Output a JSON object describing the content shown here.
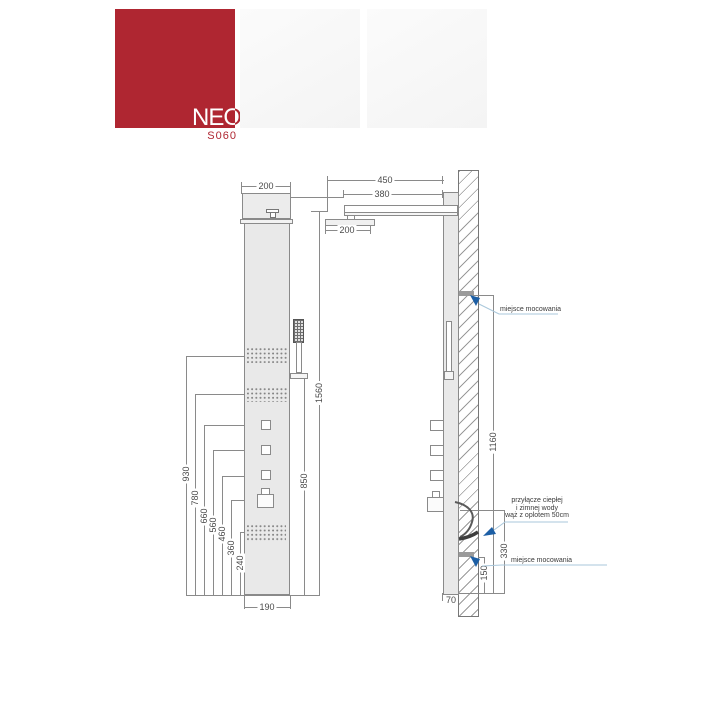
{
  "logo": {
    "brand": "NEO",
    "model": "S060",
    "brand_color": "#AF2631"
  },
  "annotation_colors": {
    "arrow_blue": "#1D5FA5",
    "leader_blue": "#A9C7DB"
  },
  "front_view": {
    "dim_width_top": "200",
    "dim_height_total": "1560",
    "dim_handshower_height": "850",
    "dim_width_body": "190",
    "dim_heights": [
      "930",
      "780",
      "660",
      "560",
      "460",
      "360",
      "240"
    ]
  },
  "side_view": {
    "dim_arm_reach": "450",
    "dim_arm_length": "380",
    "dim_head_width": "200",
    "dim_mount_span": "1160",
    "dim_hose_height": "330",
    "dim_mount_height": "150",
    "dim_panel_depth": "70",
    "note_mount_top": "miejsce mocowania",
    "note_mount_bottom": "miejsce mocowania",
    "note_hose_lines": [
      "przyłącze ciepłej",
      "i zimnej wody",
      "wąż z oplotem 50cm"
    ]
  }
}
